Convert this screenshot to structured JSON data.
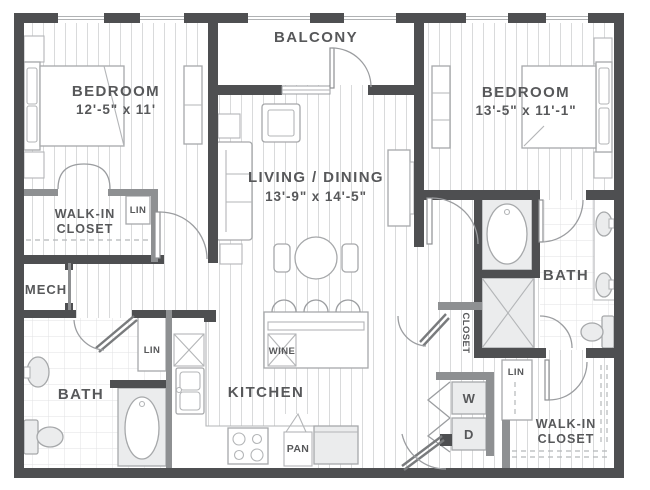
{
  "rooms": {
    "balcony": {
      "label": "BALCONY"
    },
    "bedroom_left": {
      "label": "BEDROOM",
      "dims": "12'-5\" x 11'"
    },
    "bedroom_right": {
      "label": "BEDROOM",
      "dims": "13'-5\" x 11'-1\""
    },
    "living_dining": {
      "label": "LIVING / DINING",
      "dims": "13'-9\" x 14'-5\""
    },
    "kitchen": {
      "label": "KITCHEN"
    },
    "bath_left": {
      "label": "BATH"
    },
    "bath_right": {
      "label": "BATH"
    },
    "walk_in_closet_left": {
      "line1": "WALK-IN",
      "line2": "CLOSET"
    },
    "walk_in_closet_right": {
      "line1": "WALK-IN",
      "line2": "CLOSET"
    },
    "mech": {
      "label": "MECH"
    },
    "hall_closet": {
      "label": "CLOSET"
    }
  },
  "features": {
    "linen_bedroom_left": "LIN",
    "linen_bath_left": "LIN",
    "linen_right": "LIN",
    "wine_cooler": "WINE",
    "pantry": "PAN",
    "washer": "W",
    "dryer": "D"
  },
  "colors": {
    "wall": "#4e4f51",
    "wall_secondary": "#8e9092",
    "text": "#57585a",
    "floor_line": "#d9dadb",
    "tile_line": "#e1e2e3",
    "fixture_outline": "#a6a8aa",
    "fixture_fill": "#ebeced"
  }
}
